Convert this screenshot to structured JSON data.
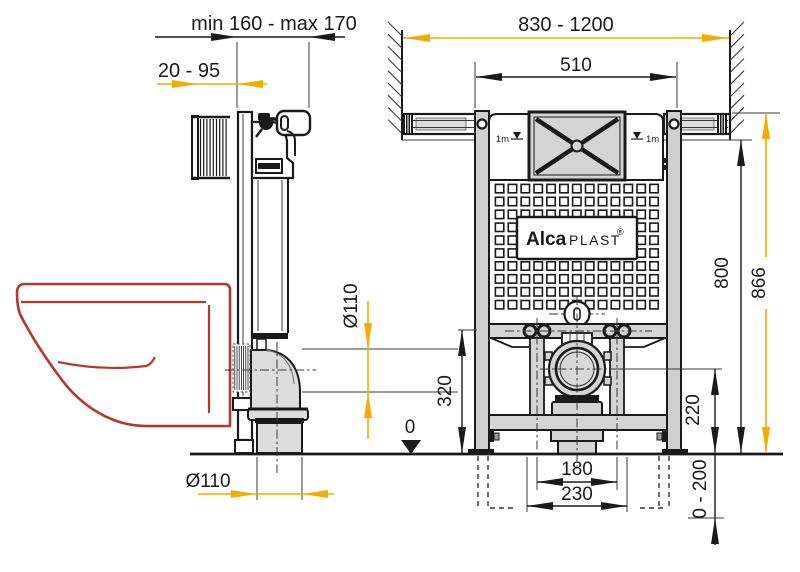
{
  "side_view": {
    "dim_depth_range": "min 160 - max 170",
    "dim_wall_distance": "20 - 95",
    "dim_pipe_diameter": "Ø110",
    "dim_outlet_diameter": "Ø110",
    "floor_datum": "0"
  },
  "front_view": {
    "dim_install_width": "830 - 1200",
    "dim_frame_width": "510",
    "dim_frame_height": "800",
    "dim_total_height": "866",
    "dim_inlet_height": "320",
    "dim_outlet_height": "220",
    "dim_bolt_spacing": "180",
    "dim_outlet_offset": "230",
    "dim_leg_adjust": "0 - 200",
    "level_mark_left": "1m",
    "level_mark_right": "1m",
    "logo": {
      "alca": "Alca",
      "plast": "PLAST",
      "registered": "®"
    }
  },
  "colors": {
    "accent_yellow": "#F2AE00",
    "toilet_red": "#B5382F",
    "line_black": "#1A1A1A"
  }
}
